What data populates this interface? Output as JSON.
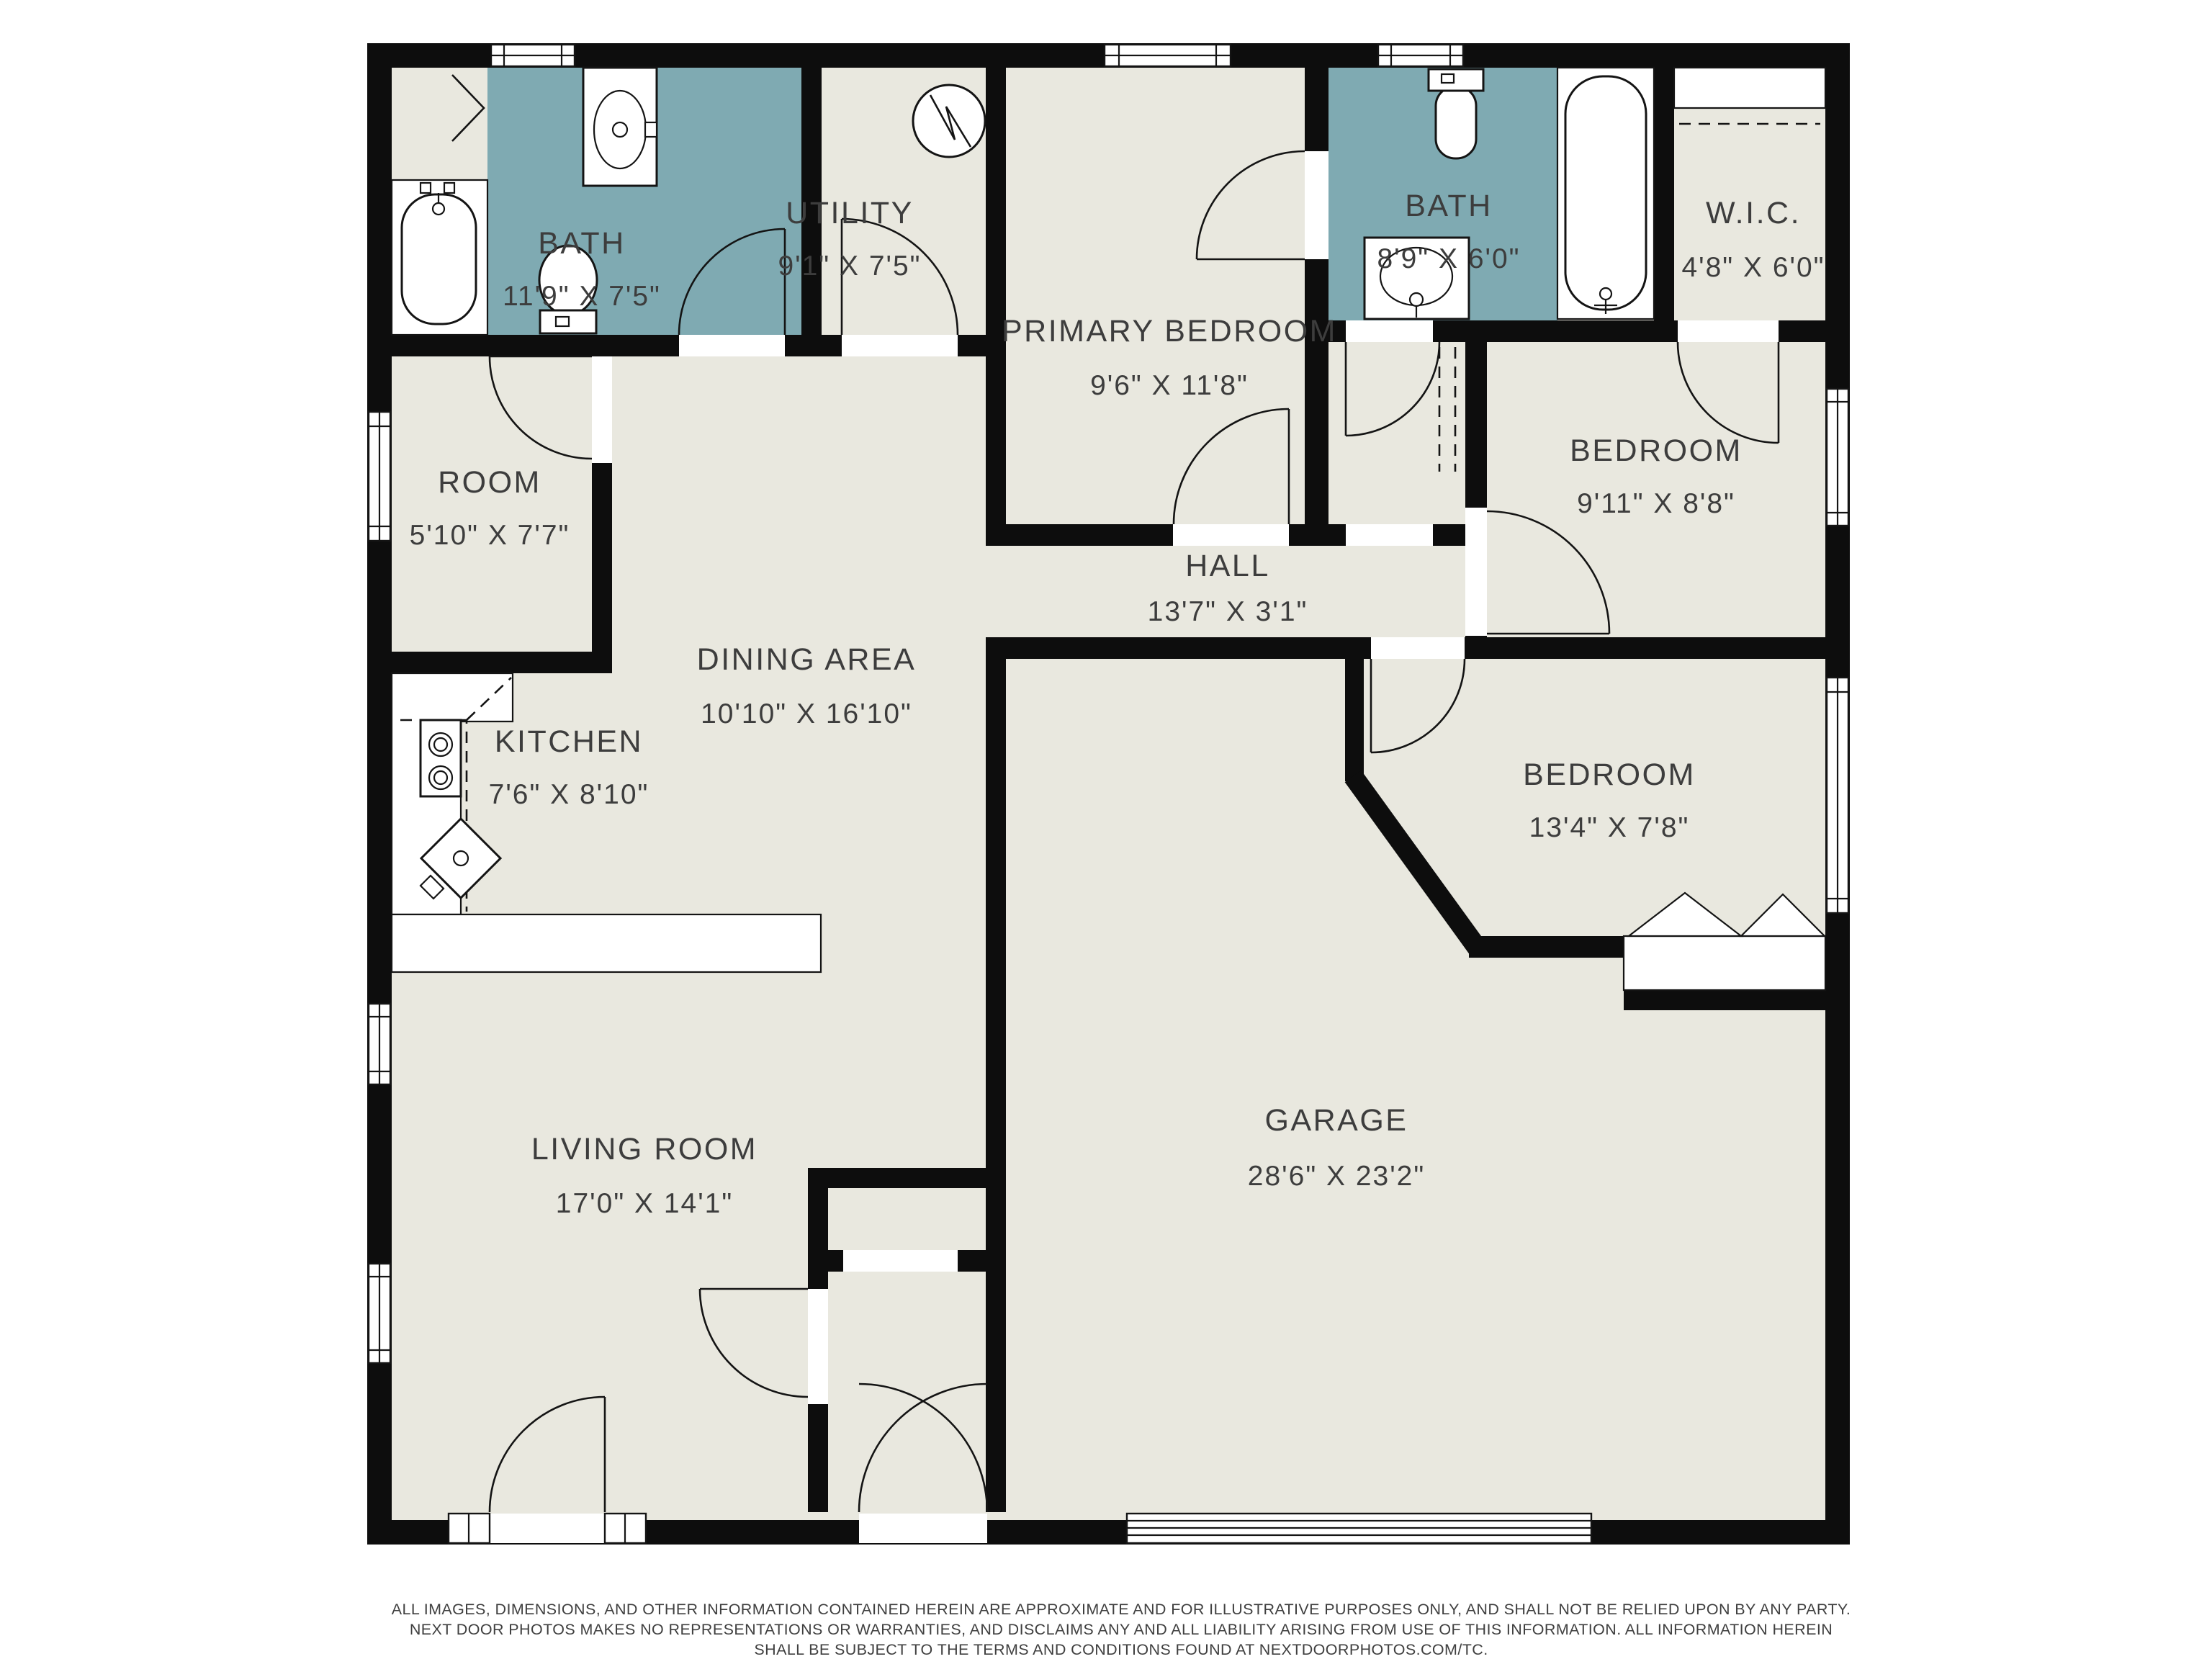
{
  "colors": {
    "floor": "#e9e8df",
    "bath": "#7faab2",
    "wall": "#0d0d0d",
    "text": "#3d3d3d",
    "paper": "#ffffff"
  },
  "rooms": [
    {
      "id": "bath-1",
      "name": "BATH",
      "dims": "11'9\" X 7'5\""
    },
    {
      "id": "utility",
      "name": "UTILITY",
      "dims": "9'1\" X 7'5\""
    },
    {
      "id": "primary-bedroom",
      "name": "PRIMARY BEDROOM",
      "dims": "9'6\" X 11'8\""
    },
    {
      "id": "bath-2",
      "name": "BATH",
      "dims": "8'9\" X 6'0\""
    },
    {
      "id": "wic",
      "name": "W.I.C.",
      "dims": "4'8\" X 6'0\""
    },
    {
      "id": "room",
      "name": "ROOM",
      "dims": "5'10\" X 7'7\""
    },
    {
      "id": "bedroom-ne",
      "name": "BEDROOM",
      "dims": "9'11\" X 8'8\""
    },
    {
      "id": "hall",
      "name": "HALL",
      "dims": "13'7\" X 3'1\""
    },
    {
      "id": "dining-area",
      "name": "DINING AREA",
      "dims": "10'10\" X 16'10\""
    },
    {
      "id": "kitchen",
      "name": "KITCHEN",
      "dims": "7'6\" X 8'10\""
    },
    {
      "id": "bedroom-e",
      "name": "BEDROOM",
      "dims": "13'4\" X 7'8\""
    },
    {
      "id": "living-room",
      "name": "LIVING ROOM",
      "dims": "17'0\" X 14'1\""
    },
    {
      "id": "garage",
      "name": "GARAGE",
      "dims": "28'6\" X 23'2\""
    }
  ],
  "icons": {
    "water_heater": "water-heater-icon",
    "bathtub": "bathtub-icon",
    "toilet": "toilet-icon",
    "sink": "sink-icon",
    "stove": "stove-icon",
    "kitchen_sink": "kitchen-sink-icon",
    "closet_rod": "closet-rod-dashed-line",
    "bifold_doors": "bifold-closet-doors-icon",
    "garage_door": "garage-door-icon"
  },
  "disclaimer": {
    "line1": "ALL IMAGES, DIMENSIONS, AND OTHER INFORMATION CONTAINED HEREIN ARE APPROXIMATE AND FOR ILLUSTRATIVE PURPOSES ONLY, AND SHALL NOT BE RELIED UPON BY ANY PARTY.",
    "line2": "NEXT DOOR PHOTOS MAKES NO REPRESENTATIONS OR WARRANTIES, AND DISCLAIMS ANY AND ALL LIABILITY ARISING FROM USE OF THIS INFORMATION. ALL INFORMATION HEREIN",
    "line3": "SHALL BE SUBJECT TO THE TERMS AND CONDITIONS FOUND AT NEXTDOORPHOTOS.COM/TC."
  }
}
